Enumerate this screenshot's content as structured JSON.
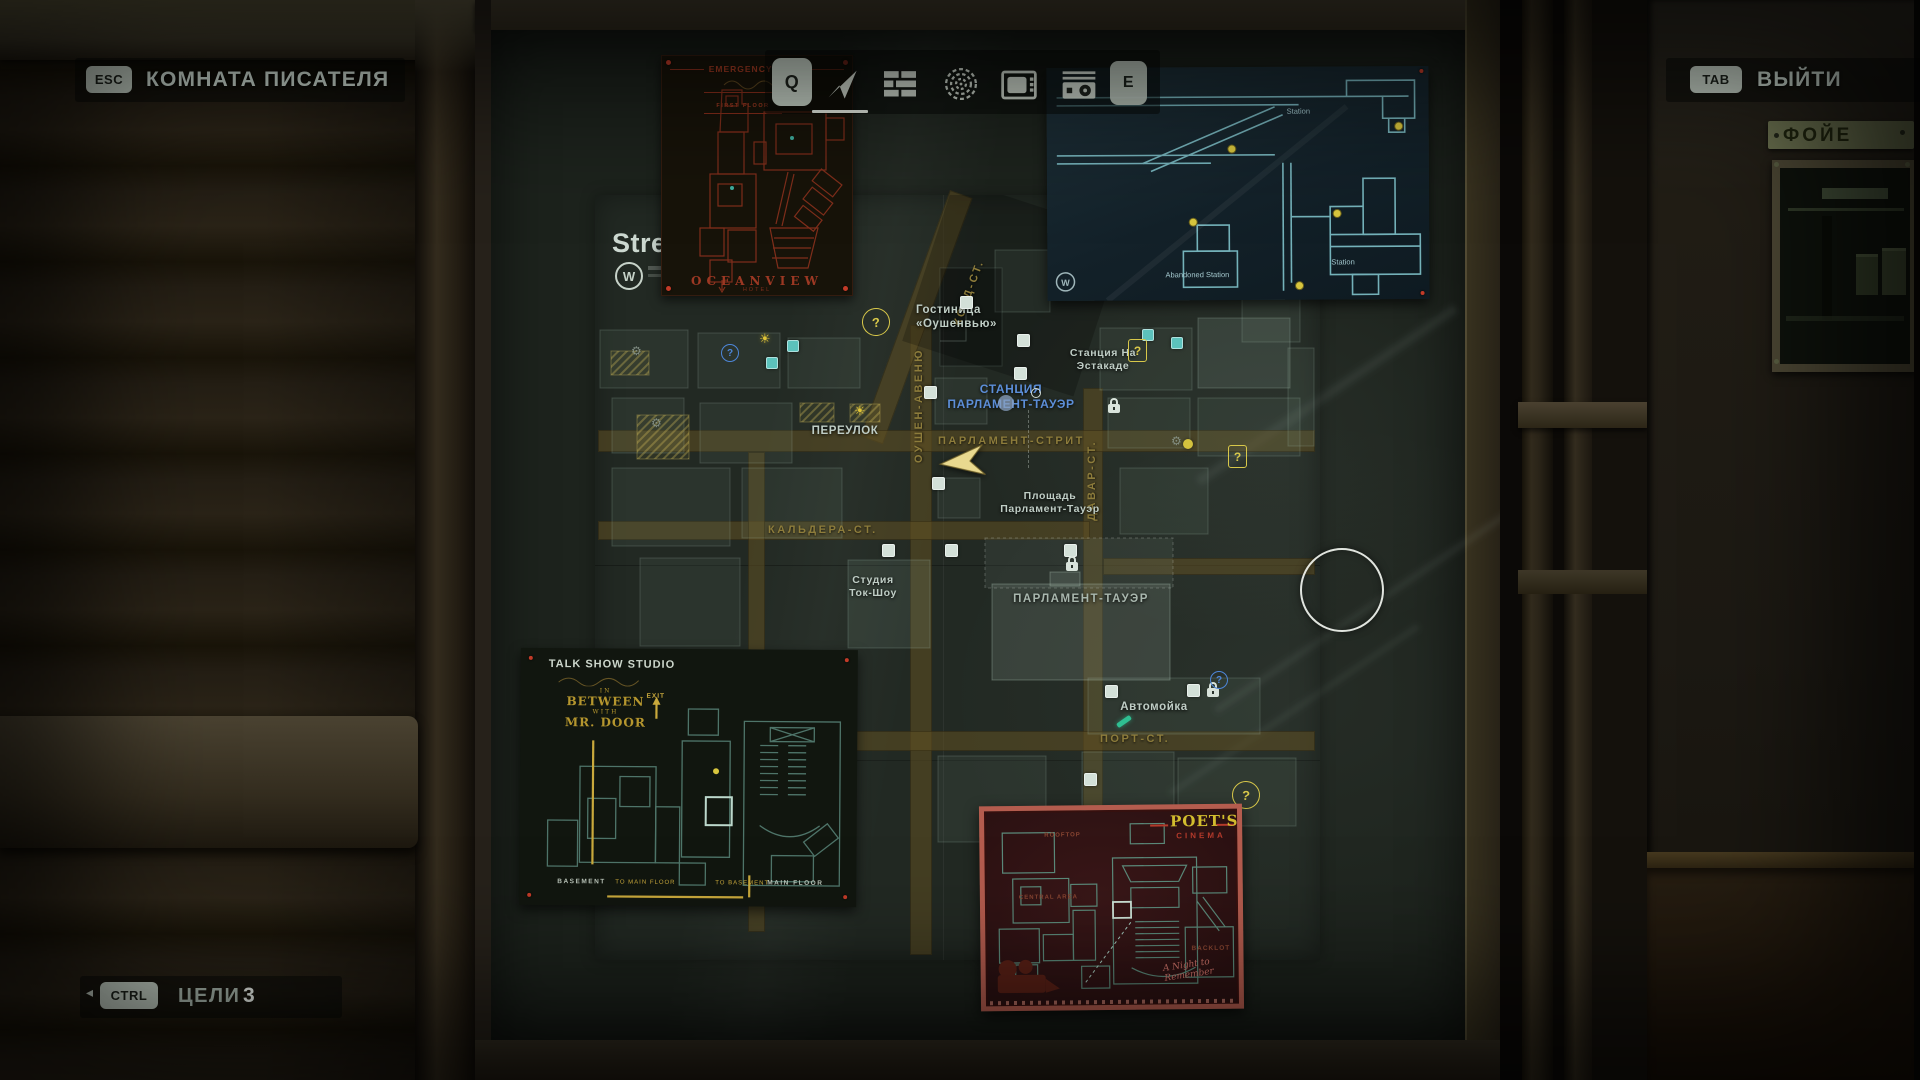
{
  "hud": {
    "colors": {
      "badge_bg": "#c2cdc2",
      "badge_text": "#1d221c",
      "text": "#c9d6cd"
    },
    "title_bar": {
      "key": "ESC",
      "title": "КОМНАТА ПИСАТЕЛЯ"
    },
    "exit": {
      "key": "TAB",
      "label": "ВЫЙТИ"
    },
    "objectives": {
      "key": "CTRL",
      "label": "ЦЕЛИ",
      "count": "3",
      "arrow": "◂"
    },
    "toolbar": {
      "prev_key": "Q",
      "next_key": "E",
      "tabs": [
        {
          "id": "map",
          "icon": "nav-arrow-icon",
          "active": true
        },
        {
          "id": "case-board",
          "icon": "grid-icon",
          "active": false
        },
        {
          "id": "mind-spiral",
          "icon": "spiral-icon",
          "active": false
        },
        {
          "id": "tv",
          "icon": "tv-icon",
          "active": false
        },
        {
          "id": "radio",
          "icon": "radio-icon",
          "active": false
        }
      ]
    }
  },
  "scene": {
    "foyer_sign": "ФОЙЕ"
  },
  "city_map": {
    "colors": {
      "street_label": "#8d7c3b",
      "place_label": "#bfcdc5",
      "station_blue": "#5c8ed8",
      "marker_yellow": "#d8c84a",
      "player_arrow": "#e9d98f"
    },
    "legend_partial": "Stre",
    "legend_logo": "W",
    "marker_glyph": "?",
    "icons": {
      "sun": "☀",
      "gear": "⚙"
    },
    "streets": {
      "kord": "КОРД-СТ.",
      "ocean": "ОУШЕН-АВЕНЮ",
      "davar": "ДАВАР-СТ.",
      "parliament": "ПАРЛАМЕНТ-СТРИТ",
      "caldera": "КАЛЬДЕРА-СТ.",
      "port": "ПОРТ-СТ."
    },
    "places": {
      "hotel": "Гостиница\n«Оушенвью»",
      "overpass_station": "Станция На\nЭстакаде",
      "tower_station": "СТАНЦИЯ\nПАРЛАМЕНТ-ТАУЭР",
      "alley": "ПЕРЕУЛОК",
      "tower_square": "Площадь\nПарламент-Тауэр",
      "parliament_tower": "ПАРЛАМЕНТ-ТАУЭР",
      "talk_show_studio": "Студия\nТок-Шоу",
      "car_wash": "Автомойка"
    }
  },
  "submaps": {
    "oceanview": {
      "title": "EMERGENCY EXITS",
      "floor": "FIRST FLOOR",
      "name": "OCEANVIEW",
      "name_sub": "HOTEL"
    },
    "subway": {
      "logo": "W",
      "labels": [
        "Abandoned Station",
        "Station",
        "Station"
      ]
    },
    "talkshow": {
      "title": "TALK SHOW STUDIO",
      "logo_top": "IN",
      "logo_main": "BETWEEN",
      "logo_mid": "WITH",
      "logo_bottom": "MR. DOOR",
      "exit": "EXIT",
      "floors": [
        "BASEMENT",
        "TO MAIN FLOOR",
        "TO BASEMENT",
        "MAIN FLOOR"
      ]
    },
    "poets": {
      "title": "POET'S",
      "subtitle": "CINEMA",
      "labels": [
        "ROOFTOP",
        "CENTRAL AREA",
        "BACKLOT"
      ],
      "signature": "A Night to\nRemember"
    }
  }
}
